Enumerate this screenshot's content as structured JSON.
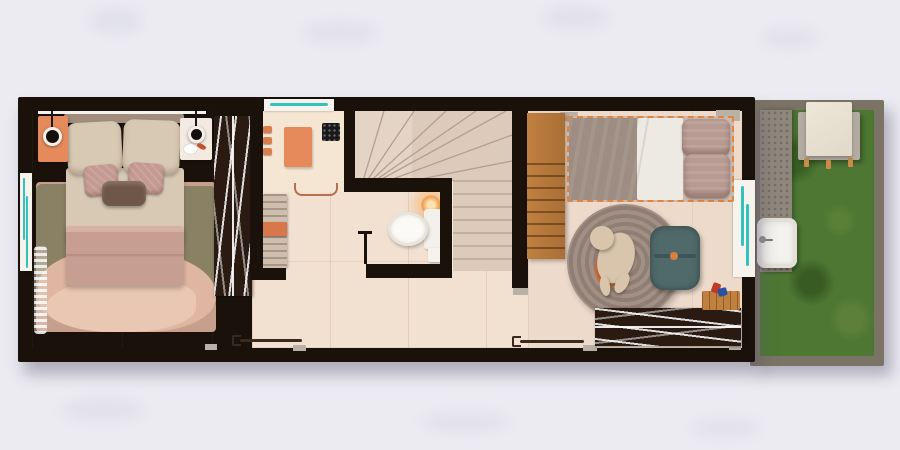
{
  "meta": {
    "kind": "architectural floor plan render",
    "view": "top-down",
    "canvas": {
      "width": 900,
      "height": 450
    }
  },
  "palette": {
    "bg": "#ecebf1",
    "wall": "#1a110b",
    "floorHall": "#f2e0d1",
    "floorMaster": "#e0c2af",
    "floorKids": "#eddacb",
    "floorBath": "#f5e5d3",
    "stairTread": "#dccaba",
    "stairLine": "#b49f8e",
    "frameWhite": "#f6f2ec",
    "glassTeal": "#35c2bd",
    "accentOrange": "#e68a5c",
    "closetDark": "#2a1a11",
    "woodLight": "#c08040",
    "rugBase": "#c6a08d",
    "rugOlive": "#8a8165",
    "rugPink": "#dfb6a2",
    "pillowBeige": "#d8c9b5",
    "cushionMauve": "#c49a91",
    "bolsterBrown": "#6f5747",
    "blanketMauve": "#c79f92",
    "blanketGrey": "#9d8d82",
    "sheetWhite": "#edeae3",
    "roundRug": "#9c8b7f",
    "poufTeal": "#506a6a",
    "toyBeige": "#d9c5ac",
    "lampGlow": "#f09b4e",
    "toiletWhite": "#fbfaf7",
    "gardenWall": "#7b7365",
    "grass": "#4d7733",
    "path": "#8f877c",
    "sinkWhite": "#f4f2ee",
    "tableCloth": "#e0d8c8",
    "platformGrey": "#b3aba0",
    "threshold": "#b9b1a6",
    "doorLine": "#3a2a1e"
  },
  "legend": {
    "rooms": [
      {
        "name": "master-bedroom",
        "furniture": "double bed, two pendant lamps, nightstands, area rug, hanger wardrobe, sheer curtain, sliding door, windows"
      },
      {
        "name": "bathroom",
        "furniture": "shower with mat and drain, toiletry shelf, towel bar, slatted bench, toilet, wall lamp, paper shelf, window"
      },
      {
        "name": "staircase",
        "furniture": "winder steps and straight run"
      },
      {
        "name": "hallway",
        "furniture": "tiled corridor, sliding door"
      },
      {
        "name": "kids-bedroom",
        "furniture": "single bed, wooden wardrobe, round braided rug, plush toy, teal pouf, hanger rug, toy blocks, window"
      },
      {
        "name": "backyard",
        "furniture": "lawn, concrete path, laundry sink, covered table"
      }
    ]
  }
}
